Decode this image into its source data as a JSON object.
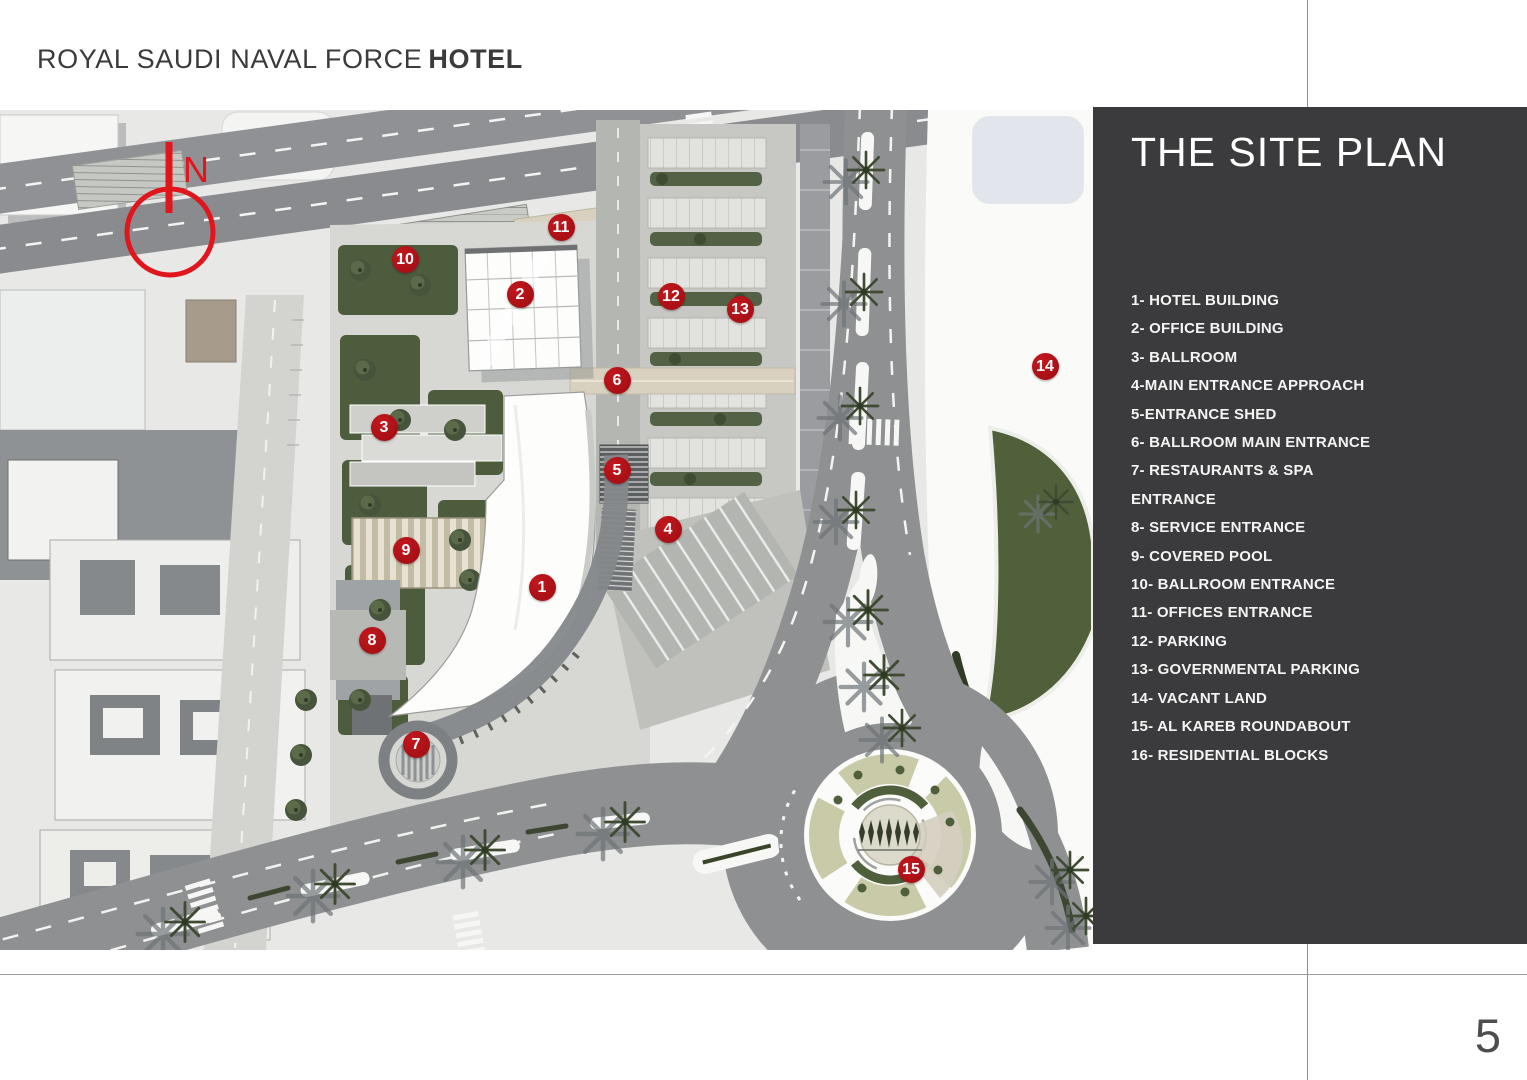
{
  "header": {
    "title_main": "ROYAL SAUDI NAVAL FORCE",
    "title_accent": "HOTEL"
  },
  "sidebar": {
    "title": "THE SITE PLAN",
    "legend_items": [
      "1- HOTEL BUILDING",
      "2- OFFICE BUILDING",
      "3- BALLROOM",
      "4-MAIN ENTRANCE APPROACH",
      "5-ENTRANCE SHED",
      "6- BALLROOM MAIN ENTRANCE",
      "7- RESTAURANTS & SPA\nENTRANCE",
      "8- SERVICE ENTRANCE",
      "9- COVERED POOL",
      "10- BALLROOM ENTRANCE",
      "11- OFFICES ENTRANCE",
      "12- PARKING",
      "13- GOVERNMENTAL PARKING",
      "14- VACANT LAND",
      "15- AL KAREB ROUNDABOUT",
      "16- RESIDENTIAL BLOCKS"
    ]
  },
  "map": {
    "north_label": "N",
    "markers": [
      {
        "n": "1",
        "x": 542,
        "y": 587
      },
      {
        "n": "2",
        "x": 520,
        "y": 294
      },
      {
        "n": "3",
        "x": 384,
        "y": 427
      },
      {
        "n": "4",
        "x": 668,
        "y": 529
      },
      {
        "n": "5",
        "x": 617,
        "y": 470
      },
      {
        "n": "6",
        "x": 617,
        "y": 380
      },
      {
        "n": "7",
        "x": 416,
        "y": 744
      },
      {
        "n": "8",
        "x": 372,
        "y": 640
      },
      {
        "n": "9",
        "x": 406,
        "y": 550
      },
      {
        "n": "10",
        "x": 405,
        "y": 259
      },
      {
        "n": "11",
        "x": 561,
        "y": 227
      },
      {
        "n": "12",
        "x": 671,
        "y": 296
      },
      {
        "n": "13",
        "x": 740,
        "y": 309
      },
      {
        "n": "14",
        "x": 1045,
        "y": 366
      },
      {
        "n": "15",
        "x": 911,
        "y": 869
      }
    ]
  },
  "footer": {
    "page_number": "5"
  },
  "colors": {
    "accent_red": "#e1161c",
    "marker_red": "#a81016",
    "sidebar_bg": "#3b3b3d"
  }
}
